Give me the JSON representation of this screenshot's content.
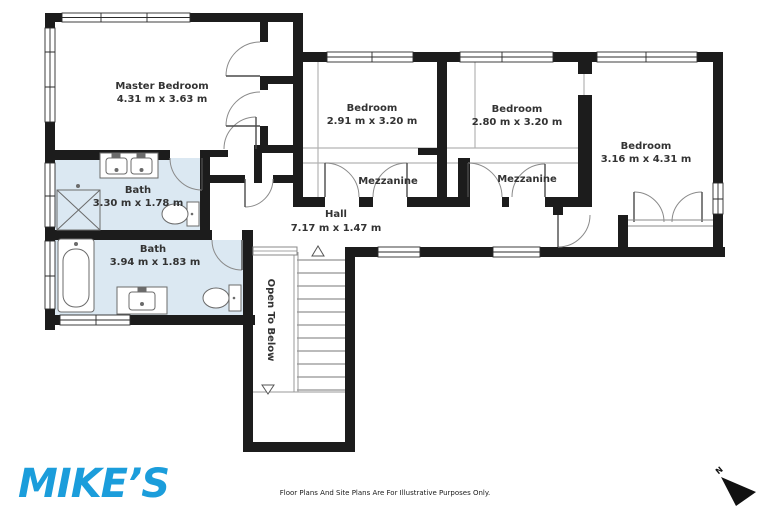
{
  "rooms": {
    "master_bedroom": {
      "name": "Master Bedroom",
      "dims": "4.31 m x 3.63 m"
    },
    "bedroom_1": {
      "name": "Bedroom",
      "dims": "2.91 m x 3.20 m"
    },
    "bedroom_2": {
      "name": "Bedroom",
      "dims": "2.80 m x 3.20 m"
    },
    "bedroom_3": {
      "name": "Bedroom",
      "dims": "3.16 m x 4.31 m"
    },
    "bath_1": {
      "name": "Bath",
      "dims": "3.30 m x 1.78 m"
    },
    "bath_2": {
      "name": "Bath",
      "dims": "3.94 m x 1.83 m"
    },
    "hall": {
      "name": "Hall",
      "dims": "7.17 m x 1.47 m"
    },
    "mezzanine_1": {
      "name": "Mezzanine"
    },
    "mezzanine_2": {
      "name": "Mezzanine"
    },
    "stair_void": {
      "name": "Open To Below"
    }
  },
  "branding": {
    "logo_text": "MIKE’S"
  },
  "footer": {
    "disclaimer": "Floor Plans And Site Plans Are For Illustrative Purposes Only."
  },
  "compass": {
    "north_label": "N"
  },
  "colors": {
    "wall": "#1c1c1c",
    "bath_fill": "#dbe8f2",
    "logo_blue": "#1b9ddb",
    "label_text": "#333333"
  }
}
